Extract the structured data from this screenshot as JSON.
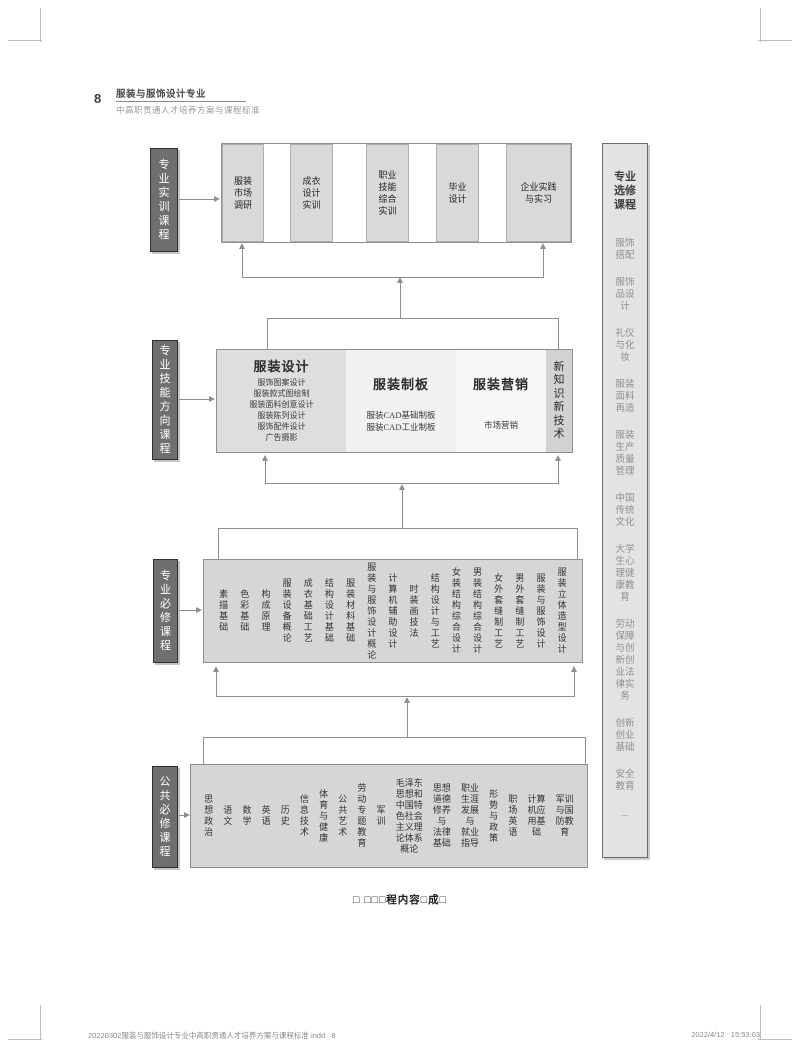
{
  "page": {
    "number": "8",
    "caption": "□ □□□程内容□成□",
    "footer_left": "20220302服装与服饰设计专业中高职贯通人才培养方案与课程标准.indd   8",
    "footer_right": "2022/4/12   15:53:03"
  },
  "header": {
    "title": "服装与服饰设计专业",
    "subtitle": "中高职贯通人才培养方案与课程标准"
  },
  "colors": {
    "label_box": "#6f6f6f",
    "cell_fill": "#d9d9d9",
    "row_fill": "#d6d6d6",
    "sidebar_fill": "#e3e3e3",
    "connector": "#8f8f8f"
  },
  "diagram": {
    "practical": {
      "label": "专\n业\n实\n训\n课\n程",
      "boxes": [
        "服装\n市场\n调研",
        "成衣\n设计\n实训",
        "职业\n技能\n综合\n实训",
        "毕业\n设计",
        "企业实践\n与实习"
      ]
    },
    "skills": {
      "label": "专\n业\n技\n能\n方\n向\n课\n程",
      "sections": [
        {
          "title": "服装设计",
          "items": "服饰图案设计\n服装款式图绘制\n服装面料创意设计\n服装陈列设计\n服饰配件设计\n广告摄影"
        },
        {
          "title": "服装制板",
          "items": "服装CAD基础制板\n服装CAD工业制板"
        },
        {
          "title": "服装营销",
          "items": "市场营销"
        },
        {
          "title": "新\n知\n识\n新\n技\n术",
          "items": ""
        }
      ]
    },
    "majorRequired": {
      "label": "专\n业\n必\n修\n课\n程",
      "courses": [
        "素\n描\n基\n础",
        "色\n彩\n基\n础",
        "构\n成\n原\n理",
        "服\n装\n设\n备\n概\n论",
        "成\n衣\n基\n础\n工\n艺",
        "结\n构\n设\n计\n基\n础",
        "服\n装\n材\n料\n基\n础",
        "服\n装\n与\n服\n饰\n设\n计\n概\n论",
        "计\n算\n机\n辅\n助\n设\n计",
        "时\n装\n画\n技\n法",
        "结\n构\n设\n计\n与\n工\n艺",
        "女\n装\n结\n构\n综\n合\n设\n计",
        "男\n装\n结\n构\n综\n合\n设\n计",
        "女\n外\n套\n缝\n制\n工\n艺",
        "男\n外\n套\n缝\n制\n工\n艺",
        "服\n装\n与\n服\n饰\n设\n计",
        "服\n装\n立\n体\n造\n型\n设\n计"
      ]
    },
    "publicRequired": {
      "label": "公\n共\n必\n修\n课\n程",
      "courses": [
        "思\n想\n政\n治",
        "语\n文",
        "数\n学",
        "英\n语",
        "历\n史",
        "信\n息\n技\n术",
        "体\n育\n与\n健\n康",
        "公\n共\n艺\n术",
        "劳\n动\n专\n题\n教\n育",
        "军\n训",
        "毛泽东\n思想和\n中国特\n色社会\n主义理\n论体系\n概论",
        "思想\n道德\n修养\n与\n法律\n基础",
        "职业\n生涯\n发展\n与\n就业\n指导",
        "形\n势\n与\n政\n策",
        "职\n场\n英\n语",
        "计算\n机应\n用基\n础",
        "军训\n与国\n防教\n育"
      ]
    },
    "electives": {
      "label": "专业\n选修\n课程",
      "items": [
        "服饰\n搭配",
        "服饰\n品设\n计",
        "礼仪\n与化\n妆",
        "服装\n面料\n再造",
        "服装\n生产\n质量\n管理",
        "中国\n传统\n文化",
        "大学\n生心\n理健\n康教\n育",
        "劳动\n保障\n与创\n新创\n业法\n律实\n务",
        "创新\n创业\n基础",
        "安全\n教育",
        "..."
      ]
    }
  }
}
